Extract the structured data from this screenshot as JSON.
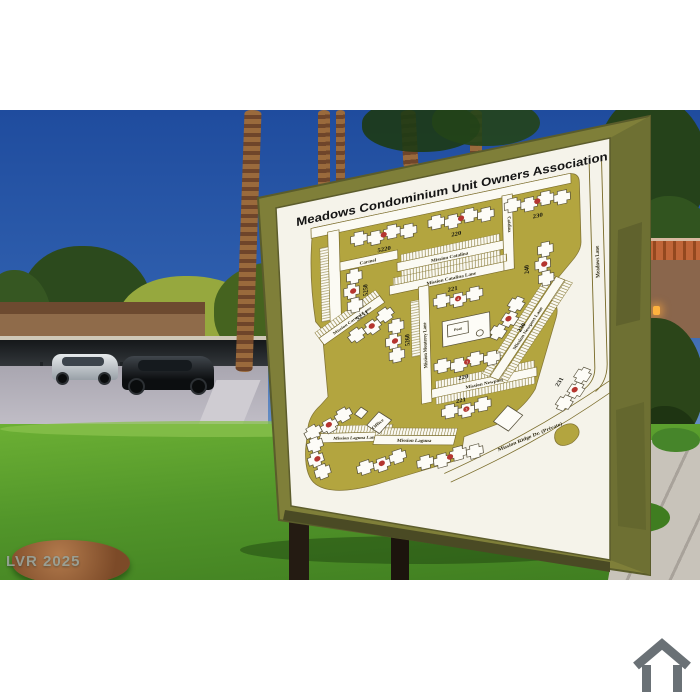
{
  "photo": {
    "watermark": "LVR 2025",
    "scene": "condominium community map sign on lawn with palm trees, carports and parked cars"
  },
  "sign": {
    "title": "Meadows Condominium Unit Owners Association",
    "map": {
      "streets": [
        {
          "label": "Carmel"
        },
        {
          "label": "Mission Catalina"
        },
        {
          "label": "Mission Catalina Lane"
        },
        {
          "label": "Catalina"
        },
        {
          "label": "Mission Monterey Lane"
        },
        {
          "label": "Mission Newport"
        },
        {
          "label": "Mission Newport Lane"
        },
        {
          "label": "Mission Carmel Lane"
        },
        {
          "label": "Mission Laguna Lane"
        },
        {
          "label": "Mission Laguna"
        },
        {
          "label": "Meadows Lane"
        },
        {
          "label": "Mission Ridge Dr. (Private)"
        }
      ],
      "buildings": [
        {
          "label": "5220",
          "marker": ""
        },
        {
          "label": "220",
          "marker": ""
        },
        {
          "label": "230",
          "marker": ""
        },
        {
          "label": "240",
          "marker": ""
        },
        {
          "label": "221",
          "marker": "4"
        },
        {
          "label": "220",
          "marker": "1"
        },
        {
          "label": "221",
          "marker": "3"
        },
        {
          "label": "230",
          "marker": ""
        },
        {
          "label": "231",
          "marker": ""
        },
        {
          "label": "5250",
          "marker": ""
        },
        {
          "label": "5251",
          "marker": ""
        },
        {
          "label": "5260",
          "marker": ""
        }
      ],
      "amenities": {
        "pool": "Pool",
        "office": "Office"
      }
    }
  },
  "colors": {
    "sky_top": "#1f4c9e",
    "grass": "#52962a",
    "frame_olive": "#7f7f39",
    "board_white": "#f5f3ea",
    "map_land": "#b3a53f",
    "marker_red": "#b5352f",
    "watermark_gray": "#9aa49c",
    "home_icon_gray": "#6a7176"
  }
}
